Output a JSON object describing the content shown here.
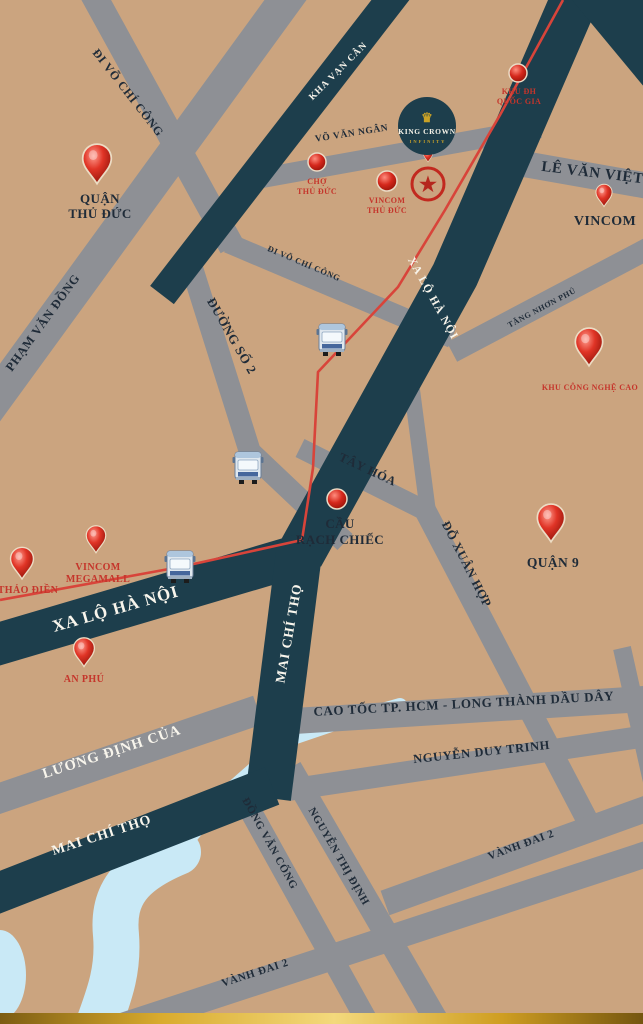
{
  "title": "King Crown Infinity location map",
  "colors": {
    "background": "#cba47f",
    "road_secondary_gray": "#8e9095",
    "road_primary_dark": "#1d3e4c",
    "metro_line_red": "#d8443a",
    "water_blue": "#c9e9f6",
    "label_dark": "#1f2b38",
    "label_red": "#c5352b",
    "label_white": "#f8f5ec",
    "gold_accent": "#c9a227"
  },
  "icons": {
    "crown_icon": "♛",
    "star_icon": "★",
    "bus_icon": "bus-front",
    "location_pin_icon": "map-pin",
    "location_dot_icon": "map-dot"
  },
  "project": {
    "name": "KING CROWN",
    "subtitle": "INFINITY"
  },
  "roads": {
    "di_vo_chi_cong_1": "ĐI VÕ CHÍ CÔNG",
    "pham_van_dong": "PHẠM VĂN ĐỒNG",
    "kha_van_can": "KHA VẠN CÂN",
    "vo_van_ngan": "VÕ VĂN NGÂN",
    "di_vo_chi_cong_2": "ĐI VÕ CHÍ CÔNG",
    "le_van_viet": "LÊ VĂN VIỆT",
    "xa_lo_ha_noi_diag": "XA LỘ HÀ NỘI",
    "duong_so_2": "ĐƯỜNG SỐ 2",
    "tang_nhon_phu": "TĂNG NHƠN PHÚ",
    "tay_hoa": "TÂY HÓA",
    "do_xuan_hop": "ĐỖ XUÂN HỢP",
    "xa_lo_ha_noi_horiz": "XA LỘ HÀ NỘI",
    "mai_chi_tho_vert": "MAI CHÍ THỌ",
    "cao_toc": "CAO TỐC TP. HCM - LONG THÀNH DẦU DÂY",
    "nguyen_duy_trinh": "NGUYỄN DUY TRINH",
    "luong_dinh_cua": "LƯƠNG ĐỊNH CỦA",
    "mai_chi_tho_diag": "MAI CHÍ THỌ",
    "dong_van_cong": "ĐỒNG VĂN CỐNG",
    "nguyen_thi_dinh": "NGUYỄN THỊ ĐỊNH",
    "vanh_dai_2_a": "VÀNH ĐAI 2",
    "vanh_dai_2_b": "VÀNH ĐAI 2"
  },
  "poi": {
    "quan_thu_duc": {
      "line1": "QUẬN",
      "line2": "THỦ ĐỨC"
    },
    "cho_thu_duc": {
      "line1": "CHỢ",
      "line2": "THỦ ĐỨC"
    },
    "vincom_thu_duc": {
      "line1": "VINCOM",
      "line2": "THỦ ĐỨC"
    },
    "khu_dh_quoc_gia": {
      "line1": "KHU ĐH",
      "line2": "QUỐC GIA"
    },
    "vincom": {
      "label": "VINCOM"
    },
    "khu_cong_nghe_cao": {
      "label": "KHU CÔNG NGHỆ CAO"
    },
    "cau_rach_chiec": {
      "line1": "CẦU",
      "line2": "RẠCH CHIẾC"
    },
    "quan_9": {
      "label": "QUẬN 9"
    },
    "thao_dien": {
      "label": "THẢO ĐIỀN"
    },
    "vincom_megamall": {
      "line1": "VINCOM",
      "line2": "MEGAMALL"
    },
    "an_phu": {
      "label": "AN PHÚ"
    }
  }
}
